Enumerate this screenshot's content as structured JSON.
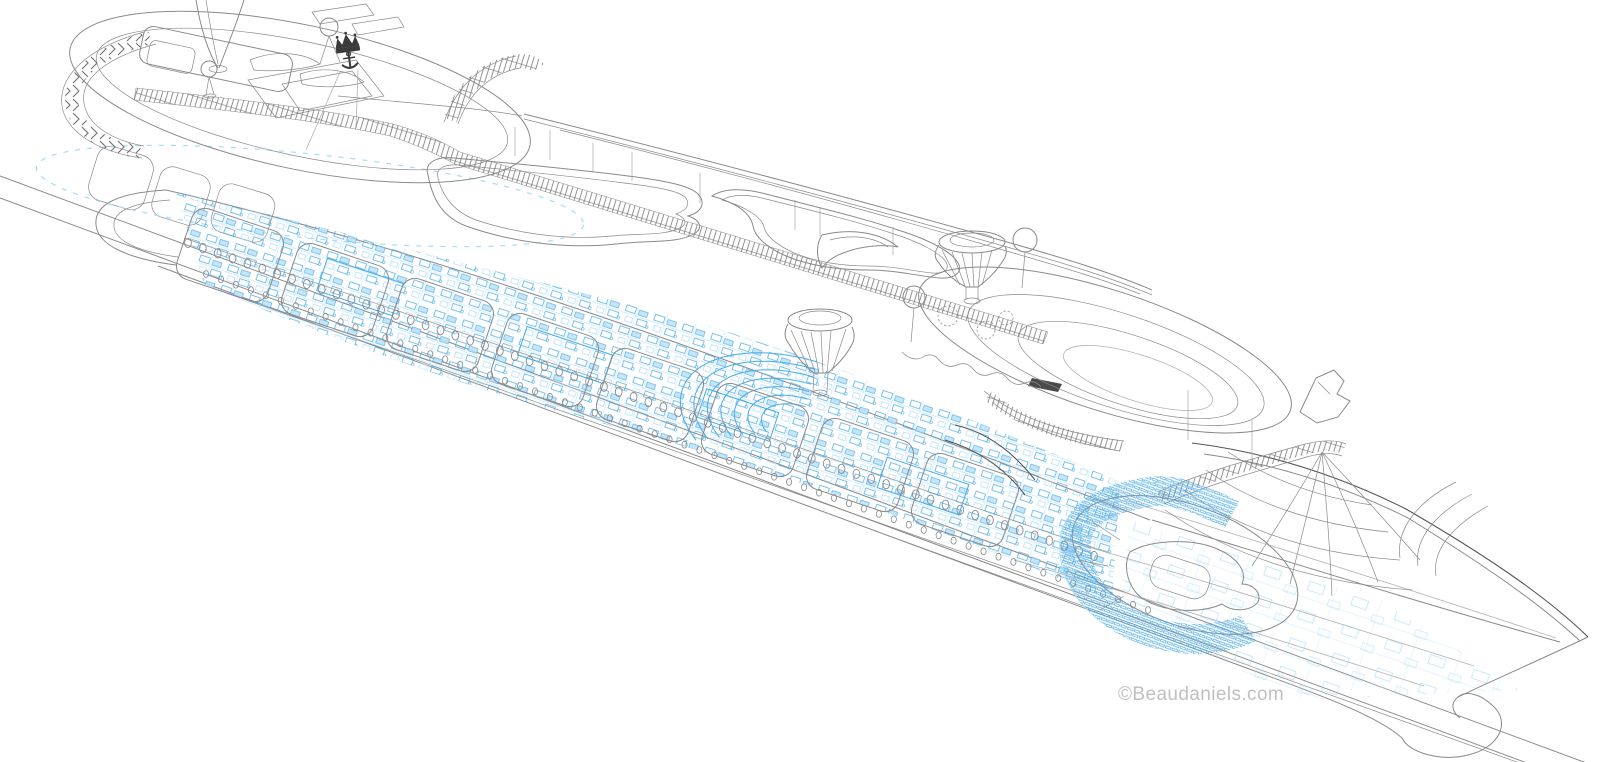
{
  "watermark": {
    "text": "©Beaudaniels.com"
  },
  "colors": {
    "background": "#ffffff",
    "line": "#8a8a8a",
    "line_dark": "#555555",
    "line_light": "#b3b3b3",
    "blueprint": "#4aabe7",
    "blueprint_light": "#a6d9f6",
    "watermark": "#c0c0c0",
    "logo": "#3a3a3a"
  },
  "drawing": {
    "porthole_rows": [
      {
        "x1": 188,
        "y1": 243,
        "x2": 1094,
        "y2": 556,
        "count": 62,
        "rx": 3.4,
        "ry": 4.6,
        "sw": 0.9
      },
      {
        "x1": 206,
        "y1": 274,
        "x2": 1148,
        "y2": 610,
        "count": 64,
        "rx": 2.6,
        "ry": 3.4,
        "sw": 0.8
      }
    ],
    "mid_theater": {
      "cx": 800,
      "cy": 428,
      "rot": 18,
      "flatten": 0.55,
      "a1": 140,
      "a2": 268,
      "radii": [
        40,
        54,
        68,
        82,
        96,
        110,
        124
      ]
    },
    "deck_modules": {
      "w": 96,
      "h": 74,
      "rx": 14,
      "rot": 18.5,
      "centers": [
        [
          230,
          255
        ],
        [
          335,
          290
        ],
        [
          440,
          325
        ],
        [
          545,
          360
        ],
        [
          650,
          395
        ],
        [
          755,
          430
        ],
        [
          860,
          465
        ],
        [
          965,
          500
        ]
      ]
    }
  }
}
